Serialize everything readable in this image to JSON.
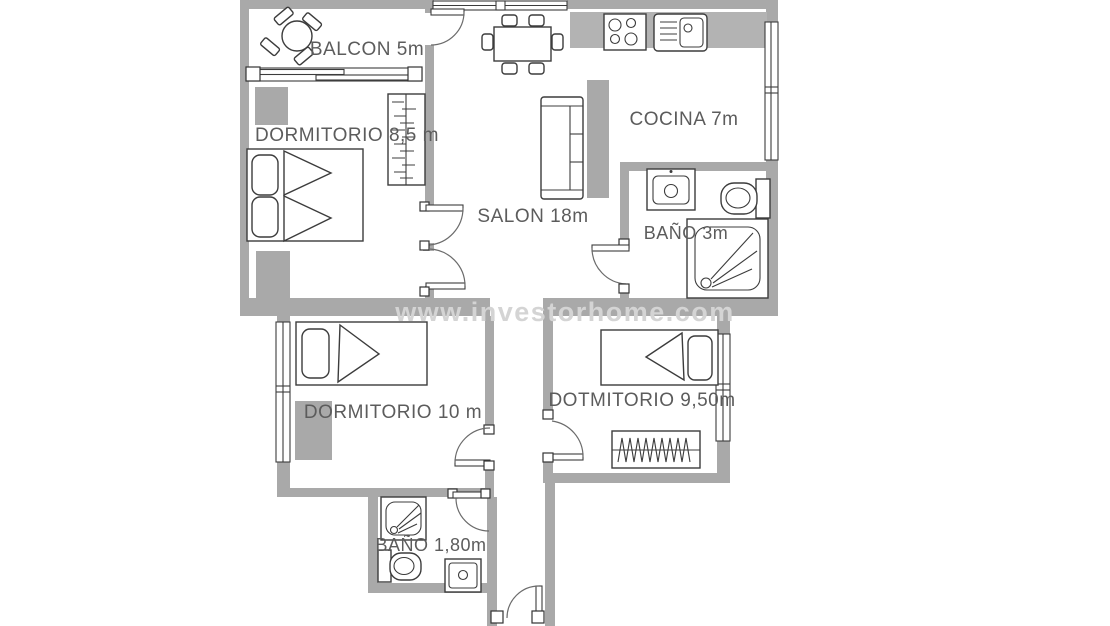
{
  "title": "Apartment floor plan",
  "watermark": {
    "text": "www.investorhome.com"
  },
  "rooms": {
    "balcon": {
      "label": "BALCON 5m"
    },
    "dormitorio_1": {
      "label": "DORMITORIO 8,5 m"
    },
    "salon": {
      "label": "SALON 18m"
    },
    "cocina": {
      "label": "COCINA 7m"
    },
    "bano_1": {
      "label": "BAÑO 3m"
    },
    "dormitorio_2": {
      "label": "DORMITORIO 10 m"
    },
    "dormitorio_3": {
      "label": "DOTMITORIO 9,50m"
    },
    "bano_2": {
      "label": "BAÑO 1,80m"
    }
  },
  "colors": {
    "wall": "#a9a9a9",
    "kitchen_counter": "#b3b3b3",
    "outline": "#3c3c3c",
    "label_text": "#5c5c5c",
    "watermark_text": "#d4d4d4",
    "background": "#ffffff"
  }
}
